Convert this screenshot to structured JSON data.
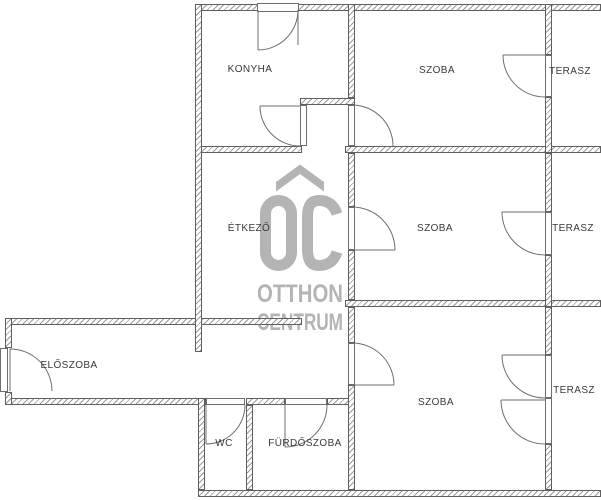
{
  "floorplan": {
    "rooms": [
      {
        "label": "KONYHA"
      },
      {
        "label": "SZOBA"
      },
      {
        "label": "TERASZ"
      },
      {
        "label": "ÉTKEZŐ"
      },
      {
        "label": "SZOBA"
      },
      {
        "label": "TERASZ"
      },
      {
        "label": "ELŐSZOBA"
      },
      {
        "label": "SZOBA"
      },
      {
        "label": "TERASZ"
      },
      {
        "label": "WC"
      },
      {
        "label": "FÜRDŐSZOBA"
      }
    ],
    "watermark": {
      "logo_text": "OC",
      "line1": "OTTHON",
      "line2": "CENTRUM",
      "color": "#b4b4b4"
    },
    "colors": {
      "background": "#ffffff",
      "wall_outline": "#5f5f5f",
      "wall_hatch": "#9a9a9a",
      "door_lines": "#6e6e6e",
      "label_text": "#3a3a3a"
    }
  }
}
